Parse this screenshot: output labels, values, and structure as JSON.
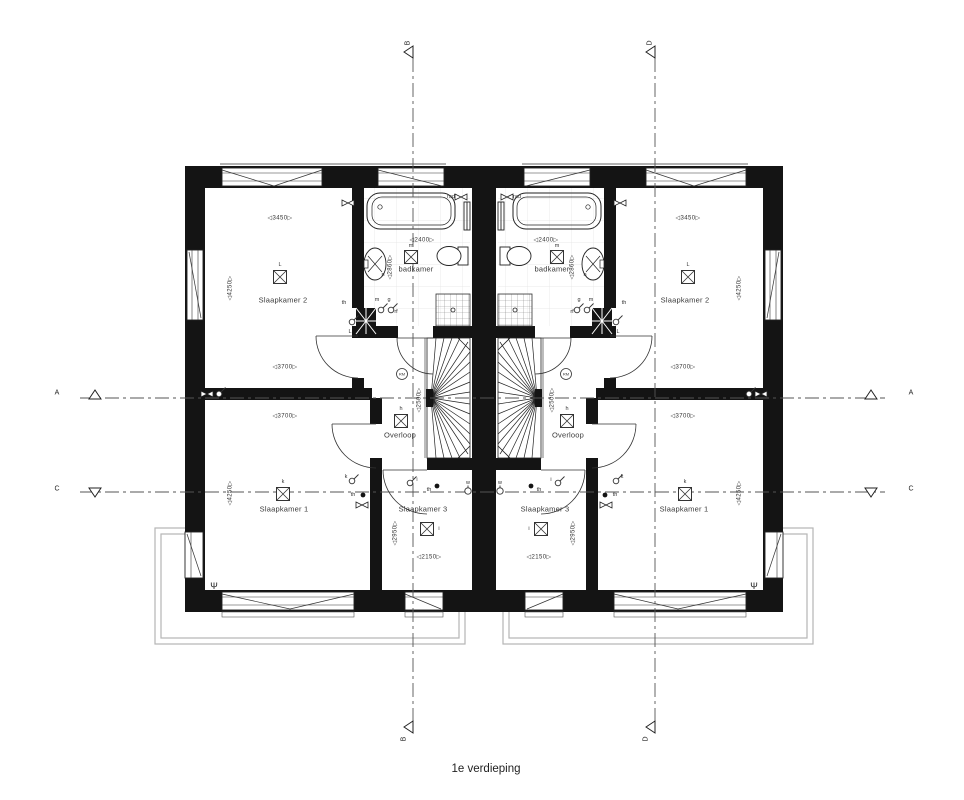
{
  "drawing": {
    "caption": "1e verdieping",
    "type": "floorplan-first-floor-two-mirrored-dwellings"
  },
  "colors": {
    "wall": "#141414",
    "line": "#333333",
    "roof": "#b5b5b5",
    "grid": "#555555",
    "tile": "#e2e2e2"
  },
  "labels": [
    {
      "name": "floor-caption",
      "cls": "caption",
      "text": "1e verdieping",
      "x": 486,
      "y": 769
    },
    {
      "name": "section-label-a-left",
      "cls": "section",
      "text": "A",
      "x": 57,
      "y": 393
    },
    {
      "name": "section-label-a-right",
      "cls": "section",
      "text": "A",
      "x": 911,
      "y": 393
    },
    {
      "name": "section-label-c-left",
      "cls": "section",
      "text": "C",
      "x": 57,
      "y": 489
    },
    {
      "name": "section-label-c-right",
      "cls": "section",
      "text": "C",
      "x": 911,
      "y": 489
    },
    {
      "name": "section-label-b-top",
      "cls": "section",
      "text": "B",
      "x": 408,
      "y": 43,
      "rot": -90
    },
    {
      "name": "section-label-d-top",
      "cls": "section",
      "text": "D",
      "x": 650,
      "y": 43,
      "rot": -90
    },
    {
      "name": "section-label-b-bottom",
      "cls": "section",
      "text": "B",
      "x": 404,
      "y": 739,
      "rot": -90
    },
    {
      "name": "section-label-d-bottom",
      "cls": "section",
      "text": "D",
      "x": 646,
      "y": 739,
      "rot": -90
    },
    {
      "name": "room-label",
      "cls": "room",
      "text": "Slaapkamer 2",
      "x": 283,
      "y": 300
    },
    {
      "name": "room-label",
      "cls": "room",
      "text": "Slaapkamer 2",
      "x": 685,
      "y": 300
    },
    {
      "name": "room-label",
      "cls": "room",
      "text": "Slaapkamer 1",
      "x": 284,
      "y": 509
    },
    {
      "name": "room-label",
      "cls": "room",
      "text": "Slaapkamer 1",
      "x": 684,
      "y": 509
    },
    {
      "name": "room-label",
      "cls": "room",
      "text": "Slaapkamer 3",
      "x": 423,
      "y": 509
    },
    {
      "name": "room-label",
      "cls": "room",
      "text": "Slaapkamer 3",
      "x": 545,
      "y": 509
    },
    {
      "name": "room-label",
      "cls": "room",
      "text": "badkamer",
      "x": 416,
      "y": 269
    },
    {
      "name": "room-label",
      "cls": "room",
      "text": "badkamer",
      "x": 552,
      "y": 269
    },
    {
      "name": "room-label",
      "cls": "room",
      "text": "Overloop",
      "x": 400,
      "y": 435
    },
    {
      "name": "room-label",
      "cls": "room",
      "text": "Overloop",
      "x": 568,
      "y": 435
    },
    {
      "name": "dim-label",
      "cls": "dim",
      "text": "◁3450▷",
      "x": 280,
      "y": 218
    },
    {
      "name": "dim-label",
      "cls": "dim",
      "text": "◁3450▷",
      "x": 688,
      "y": 218
    },
    {
      "name": "dim-label",
      "cls": "dim",
      "text": "◁3700▷",
      "x": 285,
      "y": 367
    },
    {
      "name": "dim-label",
      "cls": "dim",
      "text": "◁3700▷",
      "x": 683,
      "y": 367
    },
    {
      "name": "dim-label",
      "cls": "dim",
      "text": "◁3700▷",
      "x": 285,
      "y": 416
    },
    {
      "name": "dim-label",
      "cls": "dim",
      "text": "◁3700▷",
      "x": 683,
      "y": 416
    },
    {
      "name": "dim-label",
      "cls": "dim",
      "text": "◁2400▷",
      "x": 422,
      "y": 240
    },
    {
      "name": "dim-label",
      "cls": "dim",
      "text": "◁2400▷",
      "x": 546,
      "y": 240
    },
    {
      "name": "dim-label",
      "cls": "dim",
      "text": "◁2150▷",
      "x": 429,
      "y": 557
    },
    {
      "name": "dim-label",
      "cls": "dim",
      "text": "◁2150▷",
      "x": 539,
      "y": 557
    },
    {
      "name": "dim-label",
      "cls": "dim",
      "text": "◁4250▷",
      "x": 230,
      "y": 288,
      "rot": -90
    },
    {
      "name": "dim-label",
      "cls": "dim",
      "text": "◁4250▷",
      "x": 739,
      "y": 288,
      "rot": -90
    },
    {
      "name": "dim-label",
      "cls": "dim",
      "text": "◁4250▷",
      "x": 230,
      "y": 493,
      "rot": -90
    },
    {
      "name": "dim-label",
      "cls": "dim",
      "text": "◁4250▷",
      "x": 739,
      "y": 493,
      "rot": -90
    },
    {
      "name": "dim-label",
      "cls": "dim",
      "text": "◁2860▷",
      "x": 390,
      "y": 267,
      "rot": -90
    },
    {
      "name": "dim-label",
      "cls": "dim",
      "text": "◁2860▷",
      "x": 572,
      "y": 267,
      "rot": -90
    },
    {
      "name": "dim-label",
      "cls": "dim",
      "text": "◁2950▷",
      "x": 395,
      "y": 533,
      "rot": -90
    },
    {
      "name": "dim-label",
      "cls": "dim",
      "text": "◁2950▷",
      "x": 573,
      "y": 533,
      "rot": -90
    },
    {
      "name": "dim-label",
      "cls": "dim",
      "text": "◁2500▷",
      "x": 419,
      "y": 400,
      "rot": -90
    },
    {
      "name": "dim-label",
      "cls": "dim",
      "text": "◁2500▷",
      "x": 552,
      "y": 400,
      "rot": -90
    },
    {
      "name": "point-label",
      "cls": "tiny",
      "text": "L",
      "x": 280,
      "y": 265
    },
    {
      "name": "point-label",
      "cls": "tiny",
      "text": "L",
      "x": 688,
      "y": 265
    },
    {
      "name": "point-label",
      "cls": "tiny",
      "text": "k",
      "x": 283,
      "y": 482
    },
    {
      "name": "point-label",
      "cls": "tiny",
      "text": "k",
      "x": 685,
      "y": 482
    },
    {
      "name": "point-label",
      "cls": "tiny",
      "text": "h",
      "x": 401,
      "y": 409
    },
    {
      "name": "point-label",
      "cls": "tiny",
      "text": "h",
      "x": 567,
      "y": 409
    },
    {
      "name": "point-label",
      "cls": "tiny",
      "text": "m",
      "x": 411,
      "y": 246
    },
    {
      "name": "point-label",
      "cls": "tiny",
      "text": "m",
      "x": 557,
      "y": 246
    },
    {
      "name": "point-label",
      "cls": "tiny",
      "text": "i",
      "x": 439,
      "y": 529
    },
    {
      "name": "point-label",
      "cls": "tiny",
      "text": "i",
      "x": 529,
      "y": 529
    },
    {
      "name": "point-label",
      "cls": "tiny",
      "text": "rad",
      "x": 451,
      "y": 197
    },
    {
      "name": "point-label",
      "cls": "tiny",
      "text": "rad",
      "x": 517,
      "y": 197
    },
    {
      "name": "point-label",
      "cls": "tiny",
      "text": "th",
      "x": 344,
      "y": 303
    },
    {
      "name": "point-label",
      "cls": "tiny",
      "text": "th",
      "x": 624,
      "y": 303
    },
    {
      "name": "point-label",
      "cls": "tiny",
      "text": "th",
      "x": 353,
      "y": 495
    },
    {
      "name": "point-label",
      "cls": "tiny",
      "text": "th",
      "x": 615,
      "y": 495
    },
    {
      "name": "point-label",
      "cls": "tiny",
      "text": "th",
      "x": 429,
      "y": 490
    },
    {
      "name": "point-label",
      "cls": "tiny",
      "text": "th",
      "x": 539,
      "y": 490
    },
    {
      "name": "point-label",
      "cls": "tiny",
      "text": "L",
      "x": 350,
      "y": 332
    },
    {
      "name": "point-label",
      "cls": "tiny",
      "text": "L",
      "x": 618,
      "y": 332
    },
    {
      "name": "point-label",
      "cls": "tiny",
      "text": "m",
      "x": 377,
      "y": 300
    },
    {
      "name": "point-label",
      "cls": "tiny",
      "text": "m",
      "x": 591,
      "y": 300
    },
    {
      "name": "point-label",
      "cls": "tiny",
      "text": "g",
      "x": 389,
      "y": 300
    },
    {
      "name": "point-label",
      "cls": "tiny",
      "text": "g",
      "x": 579,
      "y": 300
    },
    {
      "name": "point-label",
      "cls": "tiny",
      "text": "rf",
      "x": 396,
      "y": 312
    },
    {
      "name": "point-label",
      "cls": "tiny",
      "text": "rf",
      "x": 572,
      "y": 312
    },
    {
      "name": "point-label",
      "cls": "tiny",
      "text": "n",
      "x": 383,
      "y": 275
    },
    {
      "name": "point-label",
      "cls": "tiny",
      "text": "n",
      "x": 585,
      "y": 275
    },
    {
      "name": "point-label",
      "cls": "tiny",
      "text": "k",
      "x": 346,
      "y": 477
    },
    {
      "name": "point-label",
      "cls": "tiny",
      "text": "k",
      "x": 622,
      "y": 477
    },
    {
      "name": "point-label",
      "cls": "tiny",
      "text": "i",
      "x": 417,
      "y": 480
    },
    {
      "name": "point-label",
      "cls": "tiny",
      "text": "i",
      "x": 551,
      "y": 480
    },
    {
      "name": "point-label",
      "cls": "tiny",
      "text": "w",
      "x": 468,
      "y": 483
    },
    {
      "name": "point-label",
      "cls": "tiny",
      "text": "w",
      "x": 500,
      "y": 483
    },
    {
      "name": "vent-symbol-label",
      "cls": "tiny9",
      "text": "Ψ",
      "x": 214,
      "y": 586
    },
    {
      "name": "vent-symbol-label",
      "cls": "tiny9",
      "text": "Ψ",
      "x": 754,
      "y": 586
    }
  ],
  "symbols": [
    {
      "type": "light",
      "x": 280,
      "y": 277
    },
    {
      "type": "light",
      "x": 688,
      "y": 277
    },
    {
      "type": "light",
      "x": 283,
      "y": 494
    },
    {
      "type": "light",
      "x": 685,
      "y": 494
    },
    {
      "type": "light",
      "x": 401,
      "y": 421
    },
    {
      "type": "light",
      "x": 567,
      "y": 421
    },
    {
      "type": "light",
      "x": 411,
      "y": 257
    },
    {
      "type": "light",
      "x": 557,
      "y": 257
    },
    {
      "type": "light",
      "x": 427,
      "y": 529
    },
    {
      "type": "light",
      "x": 541,
      "y": 529
    },
    {
      "type": "rm",
      "x": 402,
      "y": 374,
      "text": "RM"
    },
    {
      "type": "rm",
      "x": 566,
      "y": 374,
      "text": "RM"
    },
    {
      "type": "dot",
      "x": 356,
      "y": 304
    },
    {
      "type": "dot",
      "x": 612,
      "y": 304
    },
    {
      "type": "dot",
      "x": 363,
      "y": 495
    },
    {
      "type": "dot",
      "x": 605,
      "y": 495
    },
    {
      "type": "dot",
      "x": 437,
      "y": 486
    },
    {
      "type": "dot",
      "x": 531,
      "y": 486
    },
    {
      "type": "switch",
      "x": 352,
      "y": 322
    },
    {
      "type": "switch",
      "x": 616,
      "y": 322
    },
    {
      "type": "switch",
      "x": 381,
      "y": 310
    },
    {
      "type": "switch",
      "x": 587,
      "y": 310
    },
    {
      "type": "switch",
      "x": 391,
      "y": 310
    },
    {
      "type": "switch",
      "x": 577,
      "y": 310
    },
    {
      "type": "switch",
      "x": 352,
      "y": 481
    },
    {
      "type": "switch",
      "x": 616,
      "y": 481
    },
    {
      "type": "switch",
      "x": 410,
      "y": 483
    },
    {
      "type": "switch",
      "x": 558,
      "y": 483
    },
    {
      "type": "switch",
      "x": 219,
      "y": 394
    },
    {
      "type": "switch",
      "x": 749,
      "y": 394
    },
    {
      "type": "socket",
      "x": 468,
      "y": 491
    },
    {
      "type": "socket",
      "x": 500,
      "y": 491
    },
    {
      "type": "bowtie",
      "x": 348,
      "y": 203
    },
    {
      "type": "bowtie",
      "x": 620,
      "y": 203
    },
    {
      "type": "bowtie",
      "x": 461,
      "y": 197
    },
    {
      "type": "bowtie",
      "x": 507,
      "y": 197
    },
    {
      "type": "bowtie",
      "x": 362,
      "y": 505
    },
    {
      "type": "bowtie",
      "x": 606,
      "y": 505
    },
    {
      "type": "bowtie",
      "x": 207,
      "y": 394
    },
    {
      "type": "bowtie",
      "x": 761,
      "y": 394
    }
  ]
}
